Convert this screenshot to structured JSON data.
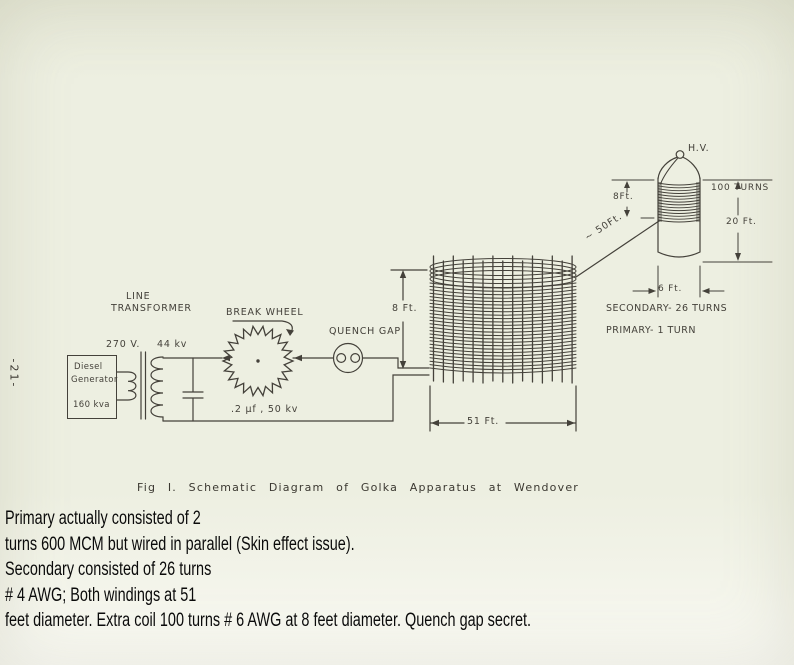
{
  "palette": {
    "paper": "#edefe1",
    "ink": "#44413a",
    "typed_text": "#0b0b0b"
  },
  "diagram": {
    "caption": "Fig I. Schematic Diagram of Golka Apparatus at Wendover",
    "page_number": "-21-",
    "generator": {
      "name_line1": "Diesel",
      "name_line2": "Generator",
      "rating": "160 kva"
    },
    "transformer": {
      "label_line1": "LINE",
      "label_line2": "TRANSFORMER",
      "input_voltage": "270 V.",
      "output_voltage": "44 kv"
    },
    "capacitor_label": ".2 μf , 50 kv",
    "break_wheel_label": "BREAK WHEEL",
    "quench_gap_label": "QUENCH GAP",
    "main_coil": {
      "height": "8 Ft.",
      "diameter": "51 Ft.",
      "secondary_label": "SECONDARY- 26 TURNS",
      "primary_label": "PRIMARY- 1 TURN"
    },
    "extra_coil": {
      "terminal": "H.V.",
      "winding_height": "8Ft.",
      "turns": "100 TURNS",
      "height": "20 Ft.",
      "diameter": "6 Ft.",
      "distance_from_main": "~ 50Ft."
    }
  },
  "notes": {
    "lines": [
      "Primary actually consisted of 2",
      "turns 600 MCM but wired in parallel (Skin effect issue).",
      "Secondary consisted of 26 turns",
      "# 4 AWG; Both windings at 51",
      "feet diameter. Extra coil 100 turns # 6 AWG at 8 feet diameter. Quench gap secret."
    ]
  }
}
